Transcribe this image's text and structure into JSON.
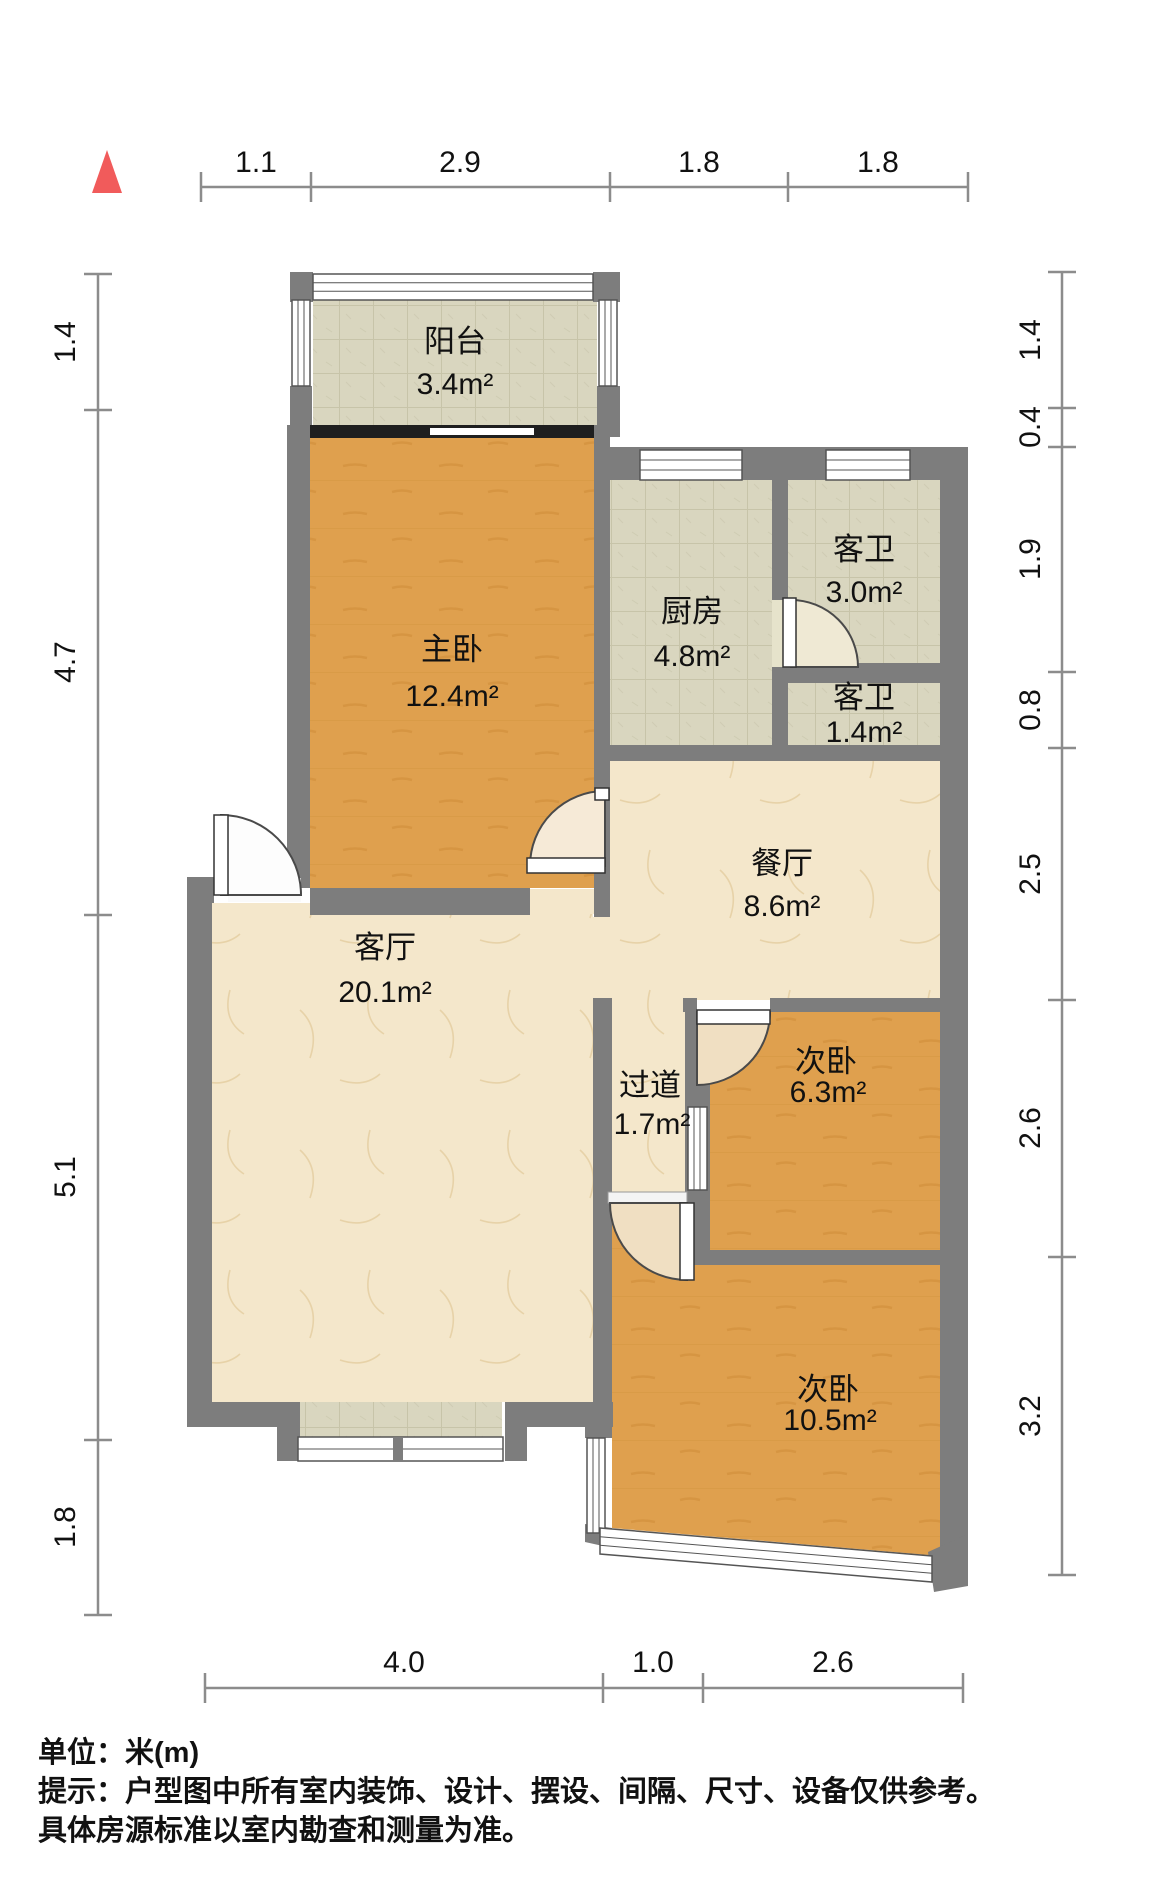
{
  "compass": {
    "icon": "north-triangle",
    "color": "#f15b5b"
  },
  "rooms": {
    "balcony": {
      "name": "阳台",
      "area": "3.4m²"
    },
    "master_bedroom": {
      "name": "主卧",
      "area": "12.4m²"
    },
    "kitchen": {
      "name": "厨房",
      "area": "4.8m²"
    },
    "guest_bath_large": {
      "name": "客卫",
      "area": "3.0m²"
    },
    "guest_bath_small": {
      "name": "客卫",
      "area": "1.4m²"
    },
    "dining_room": {
      "name": "餐厅",
      "area": "8.6m²"
    },
    "hallway": {
      "name": "过道",
      "area": "1.7m²"
    },
    "bedroom_2": {
      "name": "次卧",
      "area": "6.3m²"
    },
    "living_room": {
      "name": "客厅",
      "area": "20.1m²"
    },
    "bedroom_3": {
      "name": "次卧",
      "area": "10.5m²"
    }
  },
  "dimensions": {
    "top": [
      "1.1",
      "2.9",
      "1.8",
      "1.8"
    ],
    "left": [
      "1.4",
      "4.7",
      "5.1",
      "1.8"
    ],
    "right": [
      "1.4",
      "0.4",
      "1.9",
      "0.8",
      "2.5",
      "2.6",
      "3.2"
    ],
    "bottom": [
      "4.0",
      "1.0",
      "2.6"
    ]
  },
  "footer": {
    "unit_line": "单位：米(m)",
    "hint_line": "提示：户型图中所有室内装饰、设计、摆设、间隔、尺寸、设备仅供参考。",
    "note_line": "具体房源标准以室内勘查和测量为准。"
  },
  "colors": {
    "wall": "#7d7d7d",
    "wood_floor": "#dfa04e",
    "tile_floor": "#d9d6bf",
    "cream_floor": "#f4e7cb",
    "north_arrow": "#f15b5b",
    "dimension_line": "#8c8c8c",
    "sliding_door": "#1f1f1f"
  }
}
